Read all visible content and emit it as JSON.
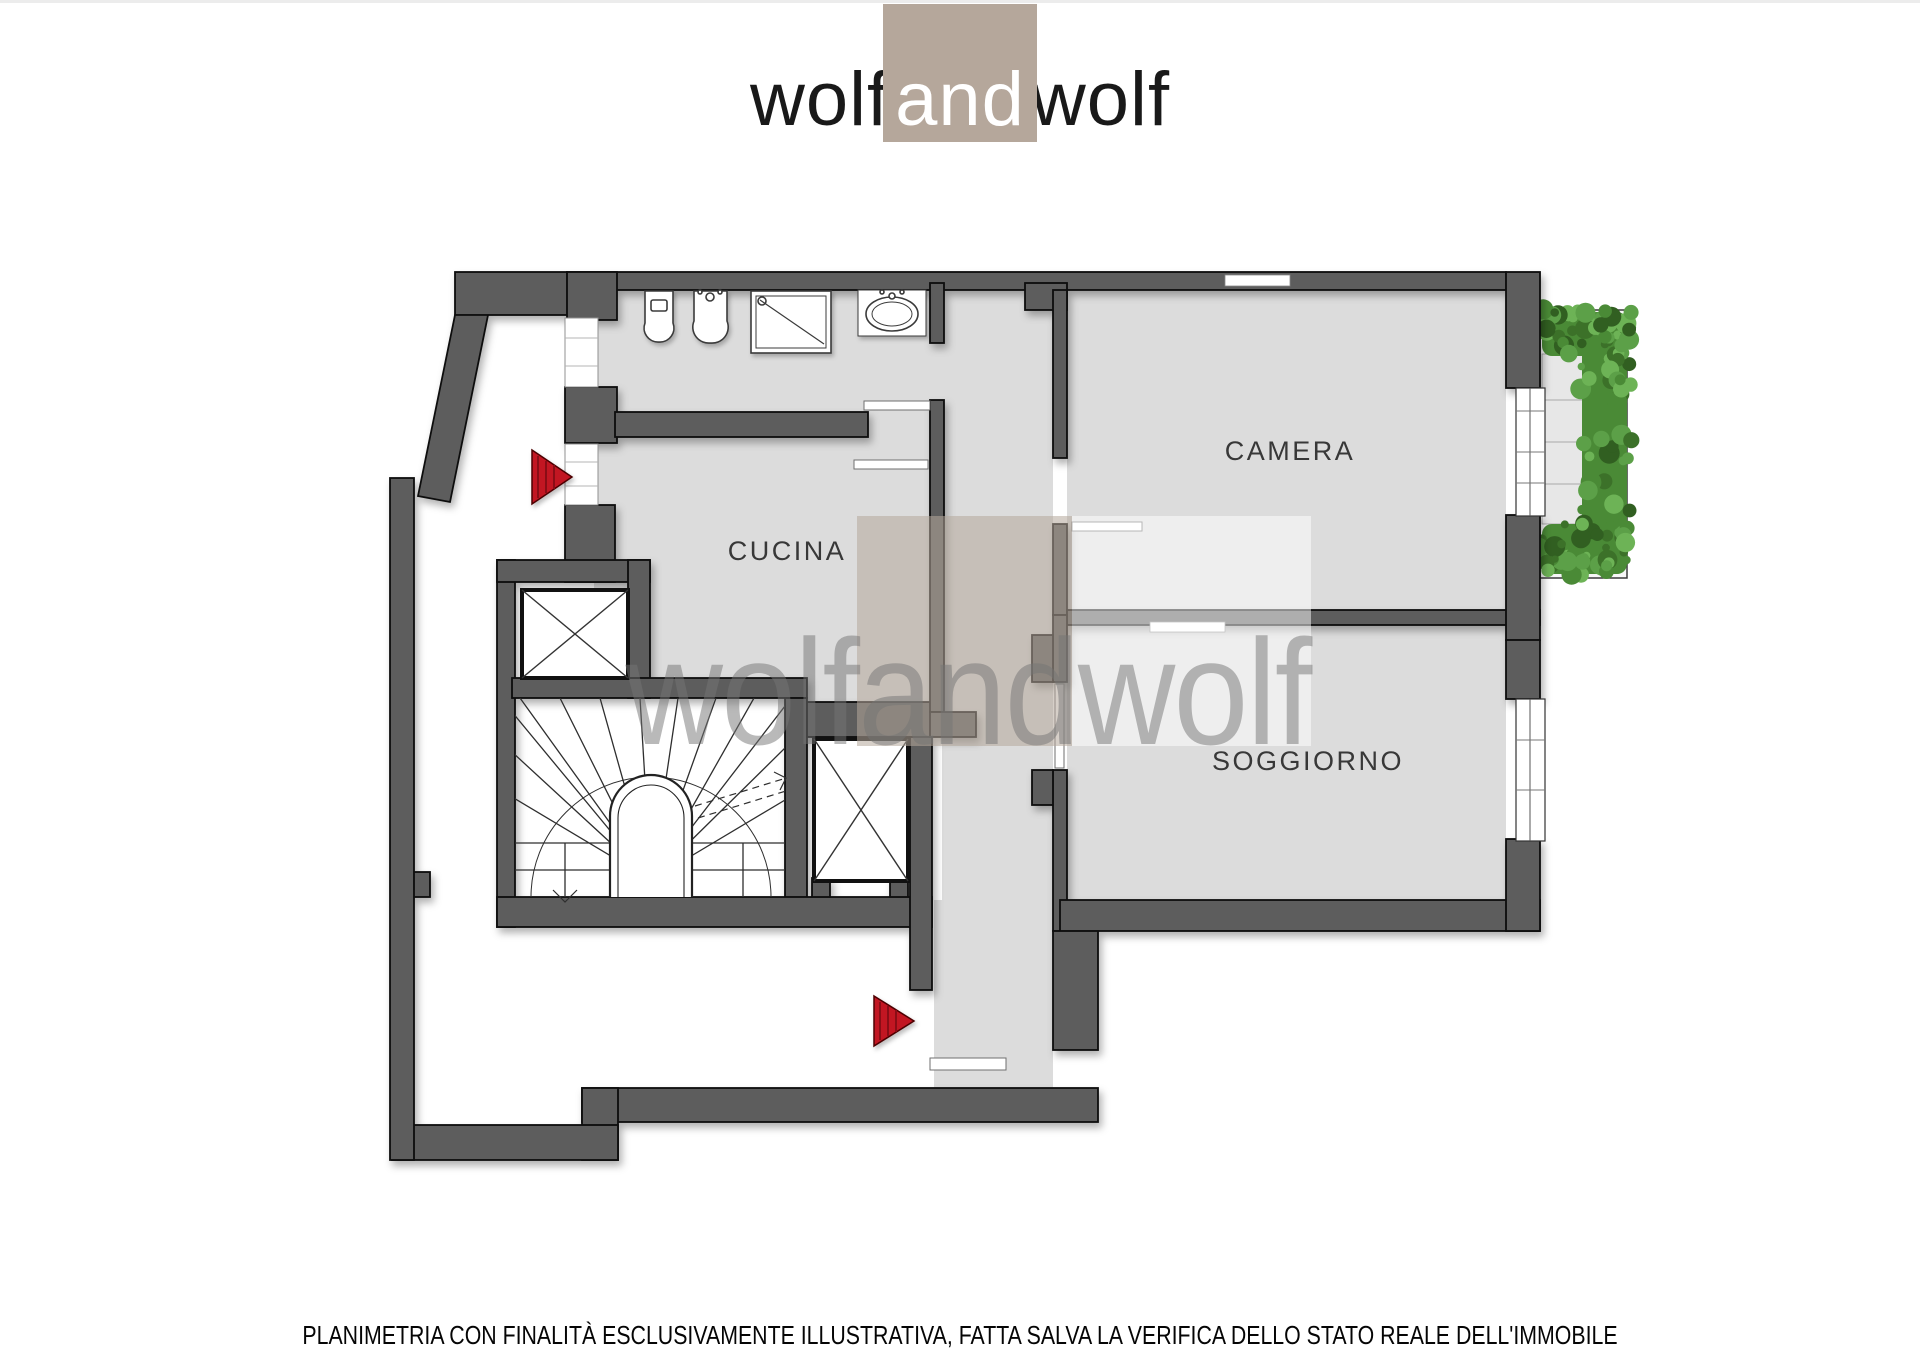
{
  "logo": {
    "part1": "wolf",
    "part2": "and",
    "part3": "wolf",
    "square_color": "#b5a79b",
    "text_color": "#191919",
    "and_text_color": "#ffffff"
  },
  "floorplan": {
    "rooms": {
      "cucina": "CUCINA",
      "camera": "CAMERA",
      "soggiorno": "SOGGIORNO"
    },
    "watermark": {
      "text": "wolfandwolf",
      "taupe_square_color": "rgba(181,167,155,0.55)",
      "white_square_color": "rgba(255,255,255,0.5)",
      "text_color": "#757575"
    },
    "colors": {
      "wall": "#5d5d5d",
      "wall_outline": "#111111",
      "floor": "#dcdcdc",
      "balcony_floor": "#e7e7e7",
      "entrance_arrow_red": "#c21422",
      "hedge_palette": [
        "#4a8a36",
        "#5ca048",
        "#3c7129",
        "#6db356",
        "#315f21"
      ]
    },
    "icons": [
      "toilet-icon",
      "bidet-icon",
      "shower-icon",
      "sink-icon",
      "elevator-icon",
      "elevator-icon",
      "staircase-icon",
      "entrance-arrow-icon",
      "entrance-arrow-icon",
      "hedge-icon",
      "window-icon",
      "window-icon"
    ]
  },
  "footer": {
    "disclaimer": "PLANIMETRIA CON FINALITÀ ESCLUSIVAMENTE ILLUSTRATIVA, FATTA SALVA LA VERIFICA DELLO STATO REALE DELL'IMMOBILE"
  }
}
